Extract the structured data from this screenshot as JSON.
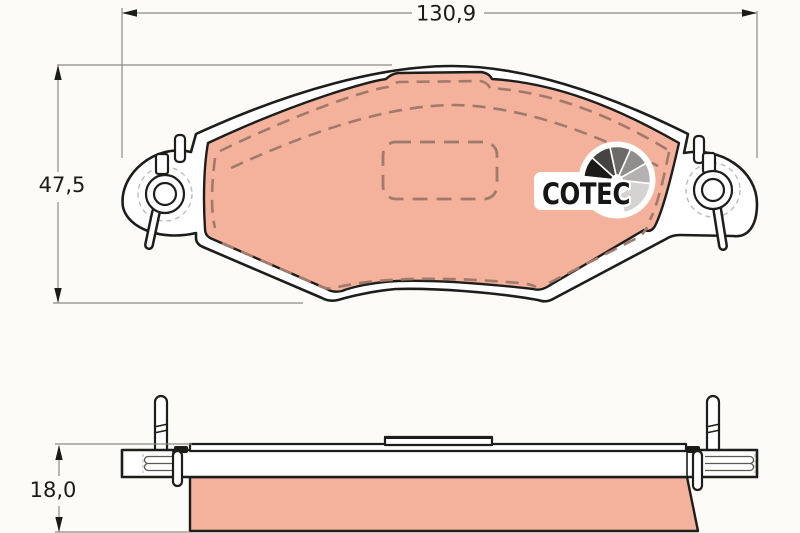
{
  "drawing": {
    "title": "brake-pad-technical-drawing",
    "views": {
      "front": "pad-front-view",
      "side": "pad-side-view"
    }
  },
  "dimensions": {
    "width_label": "130,9",
    "height_label": "47,5",
    "thickness_label": "18,0"
  },
  "logo": {
    "text": "COTEC",
    "fan_segment_colors": [
      "#1a1a18",
      "#454442",
      "#6b6a68",
      "#8f8e8c",
      "#b3b2b0",
      "#d4d3d1"
    ]
  },
  "colors": {
    "background": "#fcfbf8",
    "outline": "#1d1d1b",
    "friction_material": "#f4b19b",
    "chamfer_dash": "#a07a6b",
    "dimension_line": "#8a8a88",
    "ghost_dash": "#bcbcb7",
    "clip_detail": "#5a5952",
    "text": "#1b1b19"
  }
}
